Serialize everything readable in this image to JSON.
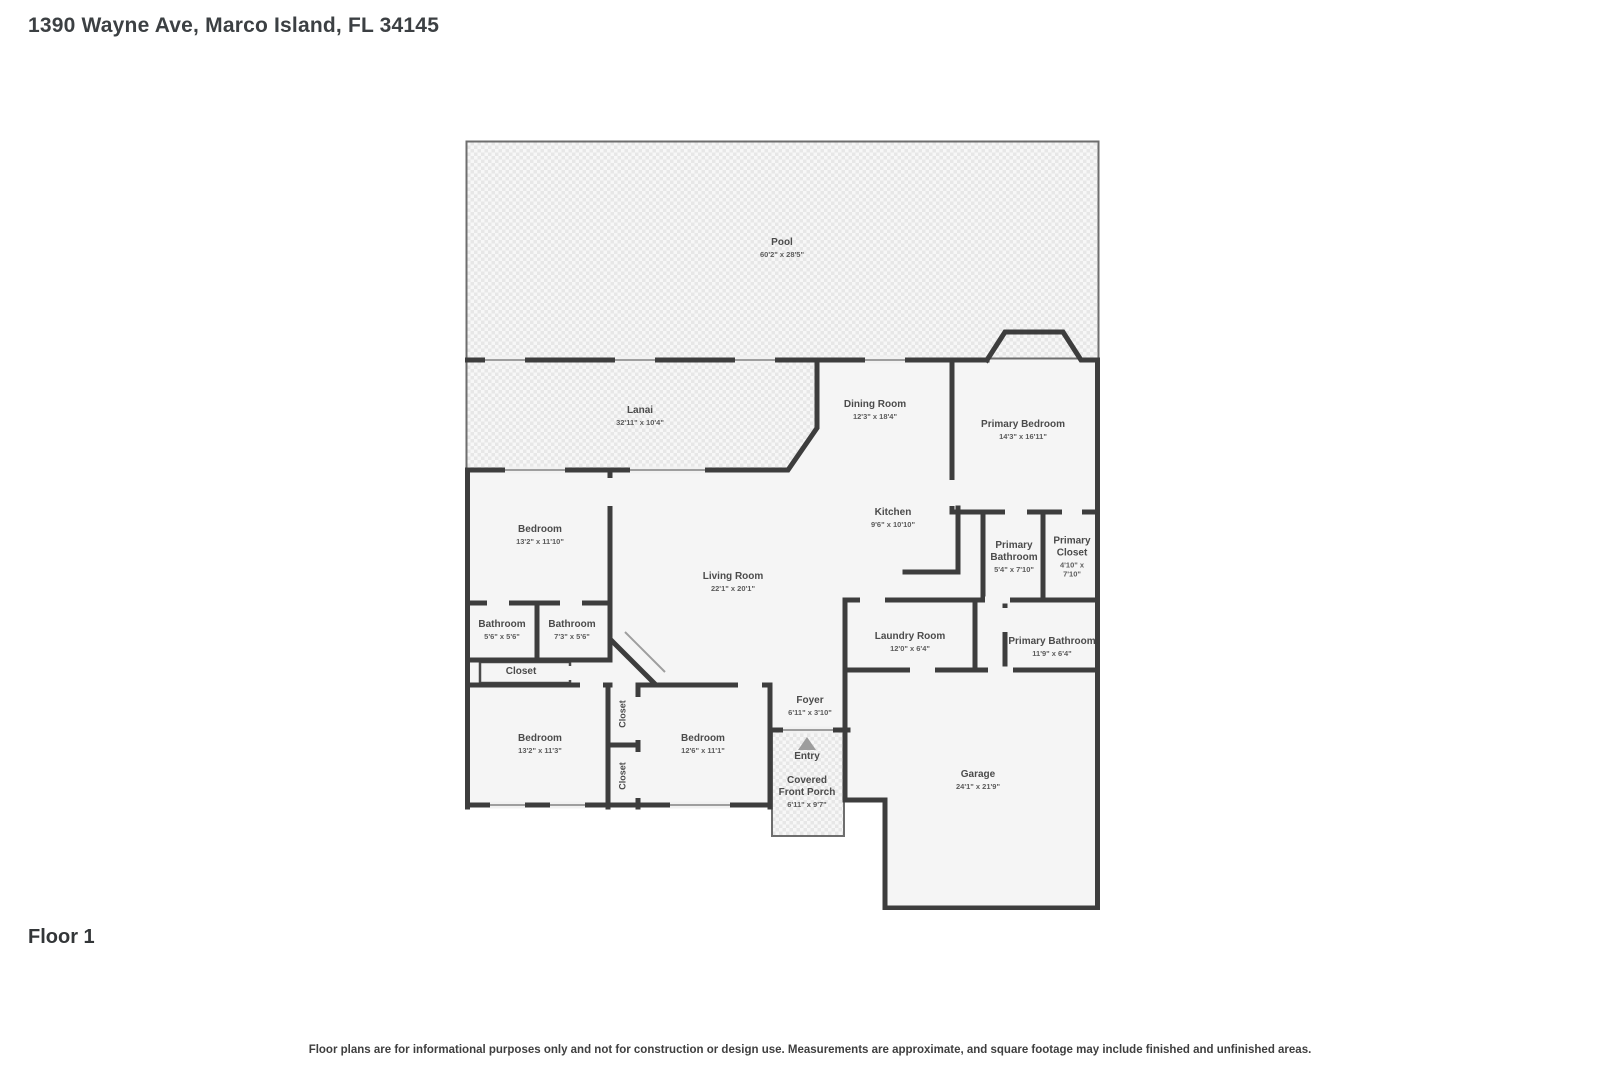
{
  "header": {
    "address": "1390 Wayne Ave, Marco Island, FL 34145"
  },
  "footer": {
    "floor_label": "Floor 1",
    "disclaimer": "Floor plans are for informational purposes only and not for construction or design use. Measurements are approximate, and square footage may include finished and unfinished areas."
  },
  "rooms": {
    "pool": {
      "name": "Pool",
      "dims": "60'2\" x 28'5\""
    },
    "lanai": {
      "name": "Lanai",
      "dims": "32'11\" x 10'4\""
    },
    "dining_room": {
      "name": "Dining Room",
      "dims": "12'3\" x 18'4\""
    },
    "primary_bedroom": {
      "name": "Primary Bedroom",
      "dims": "14'3\" x 16'11\""
    },
    "kitchen": {
      "name": "Kitchen",
      "dims": "9'6\" x 10'10\""
    },
    "bedroom_mid_left": {
      "name": "Bedroom",
      "dims": "13'2\" x 11'10\""
    },
    "living_room": {
      "name": "Living Room",
      "dims": "22'1\" x 20'1\""
    },
    "primary_bathroom_upper": {
      "name": "Primary Bathroom",
      "dims": "5'4\" x 7'10\""
    },
    "primary_closet": {
      "name": "Primary Closet",
      "dims": "4'10\" x 7'10\""
    },
    "bathroom_small": {
      "name": "Bathroom",
      "dims": "5'6\" x 5'6\""
    },
    "bathroom_hall": {
      "name": "Bathroom",
      "dims": "7'3\" x 5'6\""
    },
    "laundry_room": {
      "name": "Laundry Room",
      "dims": "12'0\" x 6'4\""
    },
    "primary_bathroom_lower": {
      "name": "Primary Bathroom",
      "dims": "11'9\" x 6'4\""
    },
    "closet_hall": {
      "name": "Closet"
    },
    "bedroom_bottom_left": {
      "name": "Bedroom",
      "dims": "13'2\" x 11'3\""
    },
    "closet_vertical_1": {
      "name": "Closet"
    },
    "closet_vertical_2": {
      "name": "Closet"
    },
    "bedroom_bottom_mid": {
      "name": "Bedroom",
      "dims": "12'6\" x 11'1\""
    },
    "foyer": {
      "name": "Foyer",
      "dims": "6'11\" x 3'10\""
    },
    "entry": {
      "name": "Entry"
    },
    "covered_front_porch": {
      "name": "Covered Front Porch",
      "dims": "6'11\" x 9'7\""
    },
    "garage": {
      "name": "Garage",
      "dims": "24'1\" x 21'9\""
    }
  },
  "colors": {
    "wall": "#3d3d3d",
    "floor_fill": "#f5f5f5",
    "pattern_tone": "#e7e7e7",
    "label_text": "#4b4b4b"
  }
}
